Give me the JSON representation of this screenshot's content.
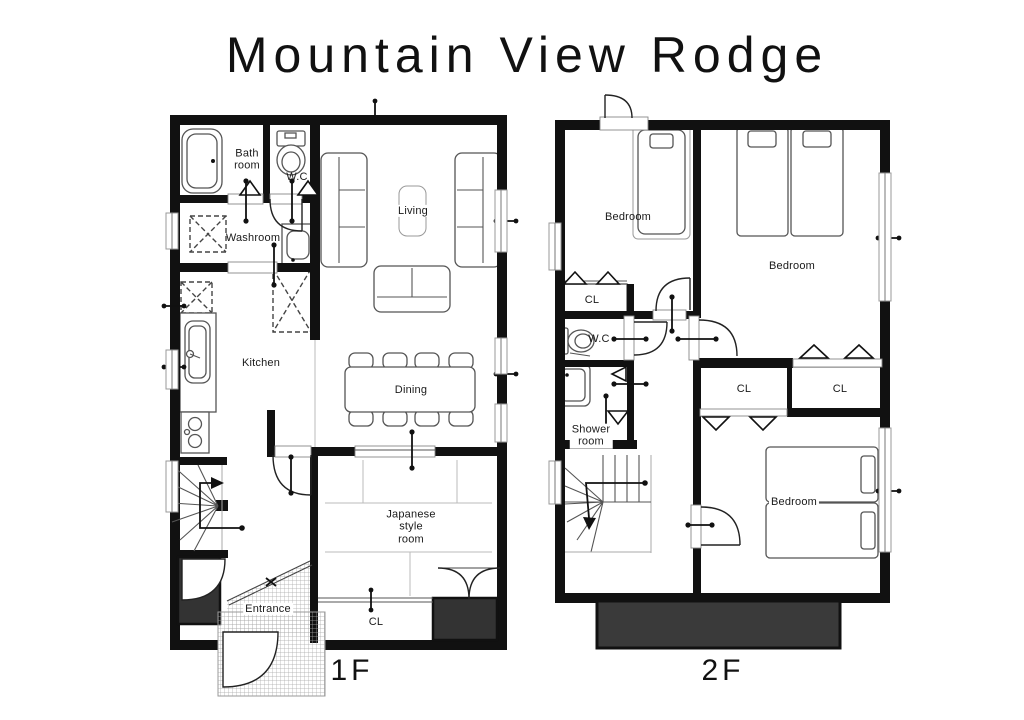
{
  "title": "Mountain View Rodge",
  "floor1": {
    "label": "1F",
    "rooms": {
      "bathroom": "Bath\nroom",
      "wc": "W.C",
      "washroom": "Washroom",
      "kitchen": "Kitchen",
      "living": "Living",
      "dining": "Dining",
      "japanese_room": "Japanese\nstyle\nroom",
      "closet": "CL",
      "entrance": "Entrance"
    }
  },
  "floor2": {
    "label": "2F",
    "rooms": {
      "bedroom_single": "Bedroom",
      "bedroom_twin": "Bedroom",
      "bedroom_double": "Bedroom",
      "closet_hall": "CL",
      "closet_left": "CL",
      "closet_right": "CL",
      "wc": "W.C",
      "shower": "Shower\nroom"
    }
  },
  "colors": {
    "wall": "#111111",
    "dark_fill": "#333333",
    "balcony_fill": "#3a3a3a"
  }
}
